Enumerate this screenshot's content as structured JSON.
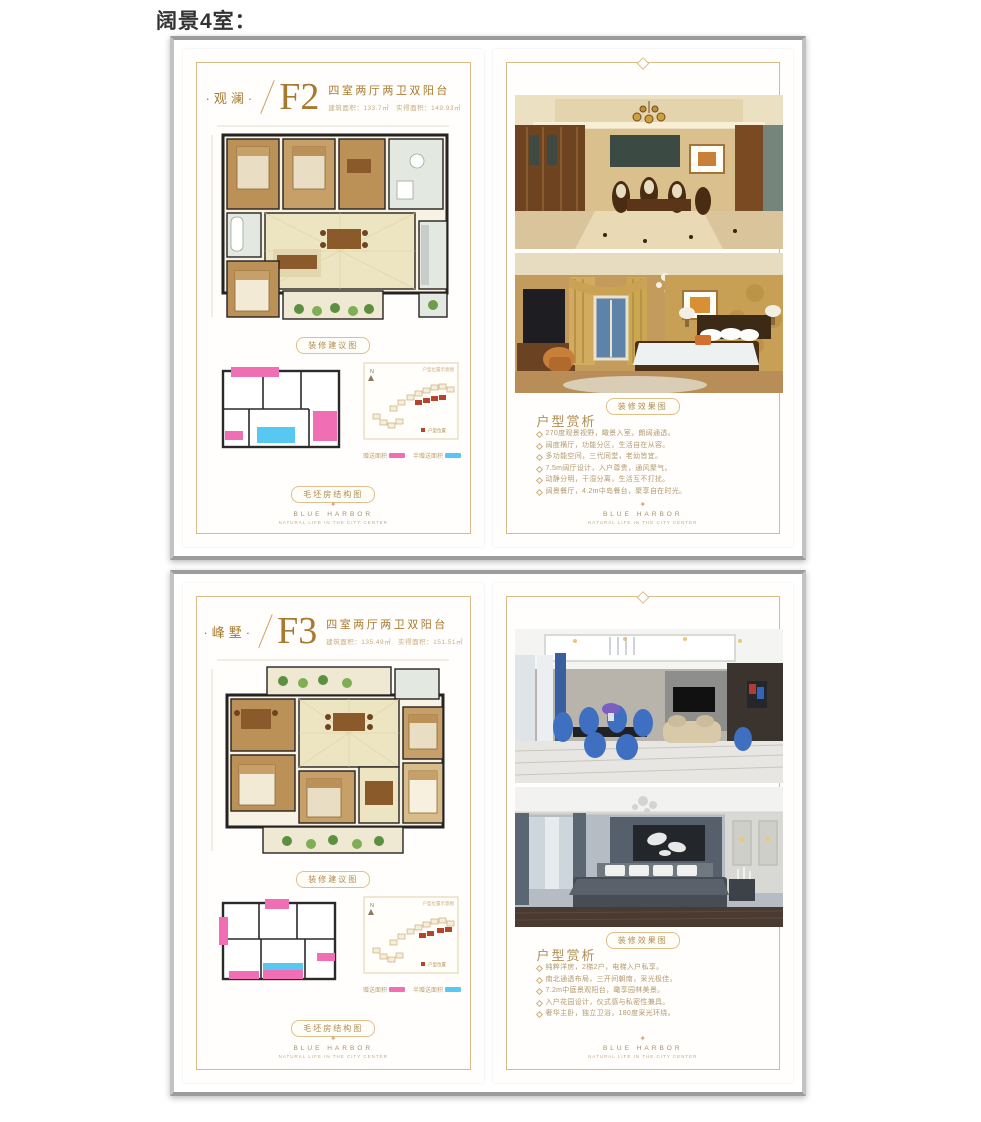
{
  "page": {
    "title": "阔景4室："
  },
  "brand": {
    "name": "BLUE HARBOR",
    "tagline": "NATURAL LIFE IN THE CITY CENTER"
  },
  "icons": {
    "ornament": "✦",
    "compass_letter": "N"
  },
  "badges": {
    "plan": "装修建议图",
    "structure": "毛坯房结构图",
    "photos": "装修效果图"
  },
  "legend": {
    "pink_label": "赠送面积",
    "blue_label": "半赠送面积",
    "pink_color": "#f06eb4",
    "blue_color": "#57c8f2"
  },
  "map": {
    "title": "户型位置示意图",
    "legend_label": "户型位置"
  },
  "analysis": {
    "heading": "户型赏析"
  },
  "colors": {
    "gold_text": "#a8792e",
    "gold_border": "#d9bd89",
    "frame_gray": "#9c9c9c"
  },
  "cards": [
    {
      "name": "·观澜·",
      "code": "F2",
      "type_line": "四室两厅两卫双阳台",
      "area_line": "建筑面积：133.7㎡　实得面积：149.93㎡",
      "bullets": [
        "270度观景视野，瞰景入室，朗阔通透。",
        "阔度横厅，功能分区，生活自在从容。",
        "多功能空间，三代同堂，老幼皆宜。",
        "7.5m阔厅设计，入户尊贵，通风聚气。",
        "动静分明，干湿分离，生活互不打扰。",
        "阔景餐厅，4.2m中岛餐台，聚享自在时光。"
      ]
    },
    {
      "name": "·峰墅·",
      "code": "F3",
      "type_line": "四室两厅两卫双阳台",
      "area_line": "建筑面积：135.49㎡　实得面积：151.51㎡",
      "bullets": [
        "纯粹洋房，2梯2户，电梯入户私享。",
        "南北通透布局，三开间朝南，采光极佳。",
        "7.2m中庭景观阳台，瞰享园林美景。",
        "入户花园设计，仪式感与私密性兼具。",
        "奢华主卧，独立卫浴，180度采光环绕。"
      ]
    }
  ]
}
